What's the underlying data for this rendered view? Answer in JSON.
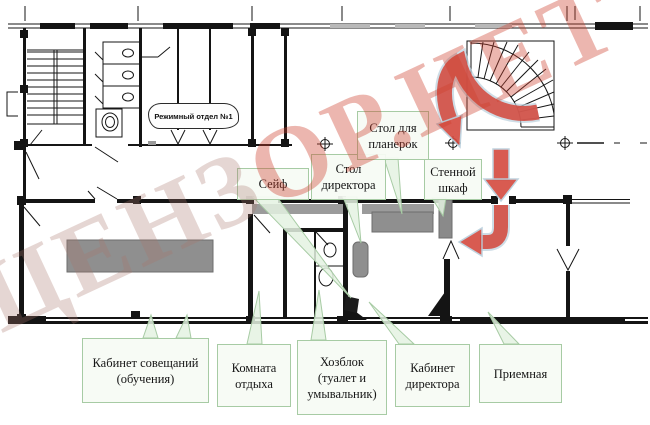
{
  "callouts": {
    "regime_dept": "Режимный отдел №1",
    "safe": "Сейф",
    "director_desk": "Стол\nдиректора",
    "planning_table": "Стол для\nпланерок",
    "wall_closet": "Стенной\nшкаф",
    "meeting_room": "Кабинет совещаний\n(обучения)",
    "rest_room": "Комната\nотдыха",
    "utility_block": "Хозблок\n(туалет и\nумывальник)",
    "director_office": "Кабинет\nдиректора",
    "reception": "Приемная"
  },
  "watermark": {
    "left": "ЦЕНЗ",
    "right": "ОР.НЕТ"
  },
  "colors": {
    "route_arrow": "#d44a3f",
    "callout_border": "#a7cba4",
    "callout_background": "#f6fbf4",
    "furniture_gray": "#8f8f8f",
    "watermark_red": "#ce3e2d"
  }
}
